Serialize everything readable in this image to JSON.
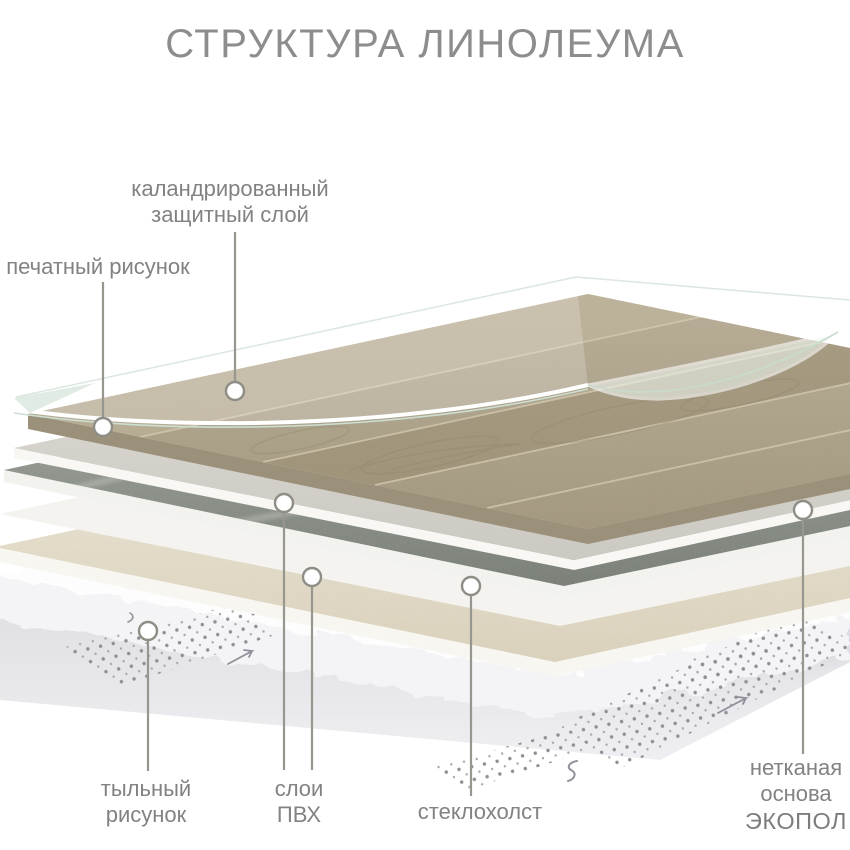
{
  "title": "СТРУКТУРА ЛИНОЛЕУМА",
  "labels": {
    "protective_layer": {
      "line1": "каландрированный",
      "line2": "защитный слой"
    },
    "printed_pattern": {
      "text": "печатный рисунок"
    },
    "back_pattern": {
      "line1": "тыльный",
      "line2": "рисунок"
    },
    "pvc_layers": {
      "line1": "слои",
      "line2": "ПВХ"
    },
    "fiberglass": {
      "text": "стеклохолст"
    },
    "nonwoven_base": {
      "line1": "нетканая",
      "line2": "основа",
      "line3": "ЭКОПОЛ"
    }
  },
  "diagram": {
    "layers_top_to_bottom": [
      "каландрированный защитный слой (прозрачная плёнка)",
      "печатный рисунок (декор под дерево)",
      "слой ПВХ (светлый)",
      "слой ПВХ (тёмный)",
      "стеклохолст",
      "слой ПВХ (кремовый)",
      "нетканая основа ЭКОПОЛ (белый ворс)",
      "тыльный рисунок (тиснение точками)"
    ]
  },
  "colors": {
    "background": "#ffffff",
    "title_text": "#8d8d8d",
    "label_text": "#828282",
    "leader_line": "#97978f",
    "marker_stroke": "#8e8e87",
    "marker_fill": "#ffffff",
    "wood_base": "#b2a68c",
    "wood_dark_band": "#97896e",
    "protective_film_edge": "#ccdfd2",
    "pvc_light_layer": "#dbd8d2",
    "pvc_dark_layer": "#8c918a",
    "fiberglass_layer": "#f4f3ef",
    "pvc_cream_layer": "#e9e2d0",
    "nonwoven_fluff": "#fdfdfe",
    "back_sheet": "#dcdce0",
    "emboss_dots": "#8e8e93"
  }
}
